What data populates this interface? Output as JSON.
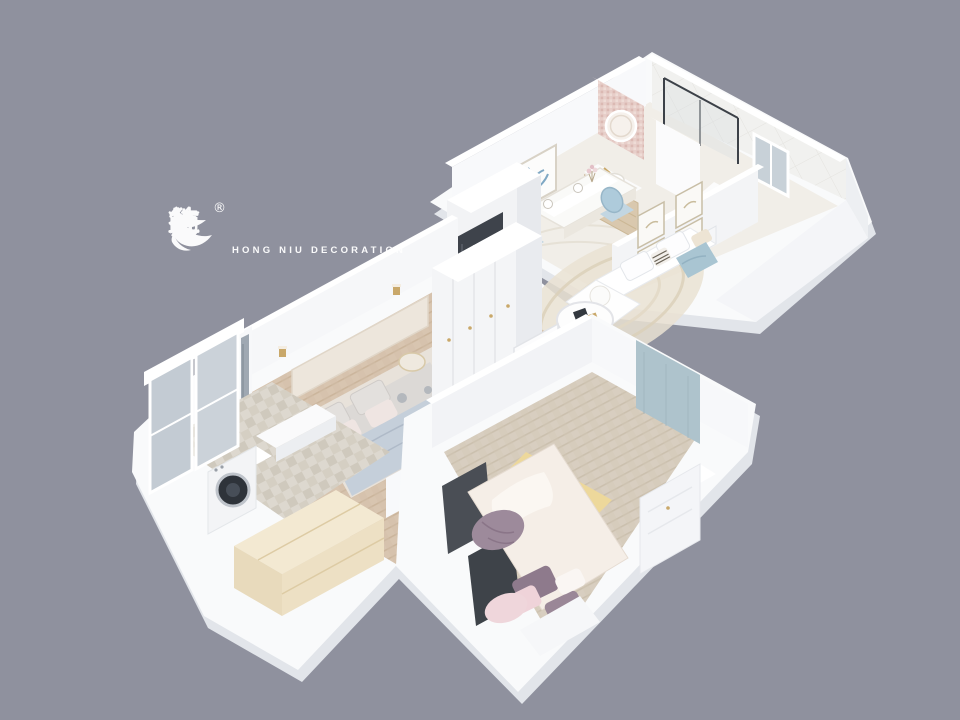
{
  "canvas": {
    "width": 960,
    "height": 720,
    "background_color": "#8F919E"
  },
  "watermark": {
    "brand_cn": "红牛装饰",
    "brand_en": "HONG NIU DECORATION",
    "registered_mark": "®",
    "color": "#FFFFFF"
  },
  "scene": {
    "type": "isometric-3d-floorplan-render",
    "rooms": [
      {
        "name": "dining-area",
        "items": [
          "dining-table",
          "blue-upholstered-chairs",
          "botanical-wall-art",
          "vanity-cabinet",
          "round-lighted-mirror",
          "mosaic-accent-wall",
          "fridge-cabinet-unit"
        ]
      },
      {
        "name": "bathroom",
        "items": [
          "glass-shower-enclosure",
          "tiled-walls"
        ]
      },
      {
        "name": "kitchen",
        "items": [
          "window",
          "counter-with-sink",
          "fruit"
        ]
      },
      {
        "name": "living-room",
        "items": [
          "white-sofa",
          "blue-throw",
          "striped-pillow",
          "four-picture-frames",
          "round-coffee-table",
          "swirl-area-rug",
          "gold-stool",
          "wire-basket"
        ]
      },
      {
        "name": "master-bedroom",
        "items": [
          "double-bed-floral-duvet",
          "blue-blanket",
          "headboard",
          "round-nightstands",
          "plant",
          "wardrobe",
          "tv-and-console",
          "pouf",
          "wall-sconces",
          "herringbone-floor"
        ]
      },
      {
        "name": "kids-bedroom",
        "items": [
          "bed-with-dark-headboard-panels",
          "pink-and-mauve-pillows",
          "mauve-blanket",
          "yellow-floral-rug",
          "blue-accent-panel",
          "white-dresser",
          "herringbone-floor"
        ]
      },
      {
        "name": "balcony-laundry",
        "items": [
          "glazed-windows",
          "washing-machine",
          "counter",
          "cream-cabinet",
          "tile-floor"
        ]
      }
    ],
    "palette": {
      "background": "#8F919E",
      "slab_white": "#F9FAFB",
      "slab_edge": "#E2E5EA",
      "wall_white": "#FFFFFF",
      "wall_shadow": "#E8EAEF",
      "floor_marble": "#F1EEE8",
      "floor_wood_master": "#D8C5B0",
      "floor_wood_kids": "#D8CEC0",
      "balcony_tile": "#DDD8CF",
      "mosaic_pink": "#E7CEC9",
      "accent_blue": "#AEC5D2",
      "accent_pink": "#EFD4DA",
      "accent_mauve": "#8E7A8C",
      "accent_yellow_rug": "#EDD89B",
      "accent_gold": "#D8B869",
      "appliance_dark": "#33383F",
      "cream_cabinet": "#F3E9D2",
      "glass": "#C4CDD5",
      "wood_cabinet": "#D9C8AE"
    }
  }
}
